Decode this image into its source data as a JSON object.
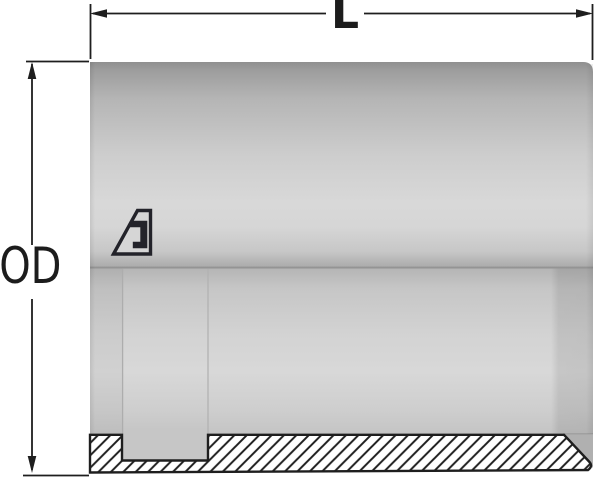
{
  "drawing": {
    "type": "technical-drawing",
    "dimension_labels": {
      "length": "L",
      "outer_diameter": "OD"
    },
    "logo_icon": "alfagomma-logo",
    "colors": {
      "line": "#1e1e1e",
      "background": "#ffffff",
      "body_highlight": "#d8d8d8",
      "body_shadow": "#949494",
      "bore_chamfer_shadow": "#b0b0b0",
      "hatch_fill": "#ffffff"
    }
  }
}
